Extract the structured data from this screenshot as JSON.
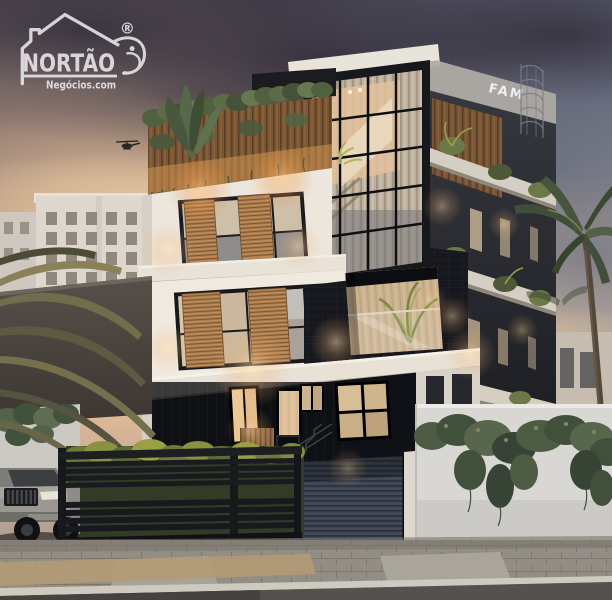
{
  "watermark": {
    "brand": "NORTÃO",
    "subtitle": "Negócios.com",
    "registered_mark": "®"
  },
  "rooftop_sign": {
    "text": "FAM"
  },
  "scene": {
    "caption": "Dusk 3D rendering of a modern multi-storey residence with rooftop garden, wooden shutters, a glass staircase tower, black slat gate, silver SUV and palm trees."
  },
  "palette": {
    "sky_top": "#443e4a",
    "sky_horizon_warm": "#e3c09a",
    "sky_right_cool": "#7d8ba0",
    "facade_white": "#ece6dc",
    "facade_black": "#17181c",
    "wood_shutter": "#ad7e4e",
    "foliage_green": "#51603e",
    "warm_light": "#f2b477",
    "garage_door_gray": "#3e4552",
    "gate_black": "#17181c",
    "car_silver": "#a8a5a0",
    "ivy_wall_white": "#d8d7d3",
    "sidewalk_gray": "#928e86",
    "asphalt": "#54524e",
    "watermark_white": "#f5f5f7",
    "sign_white": "#eceef0"
  }
}
